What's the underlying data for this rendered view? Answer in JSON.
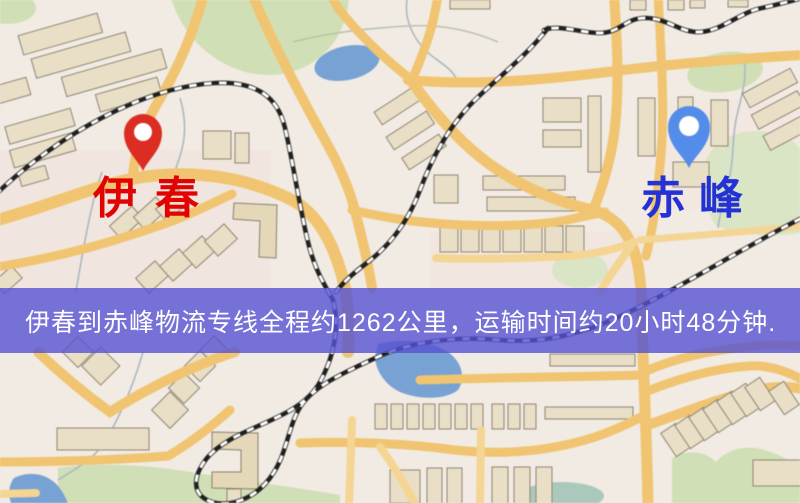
{
  "banner": {
    "text": "伊春到赤峰物流专线全程约1262公里，运输时间约20小时48分钟.",
    "background_color": "#5653d3",
    "text_color": "#ffffff",
    "origin": "伊春",
    "destination": "赤峰",
    "distance_km": "1262",
    "duration": "20小时48分钟"
  },
  "markers": {
    "origin": {
      "label": "伊春",
      "pin_color": "#e72a1d",
      "label_color": "#e20202"
    },
    "destination": {
      "label": "赤峰",
      "pin_color": "#4f8cf2",
      "label_color": "#2331d6"
    }
  },
  "map": {
    "palette": {
      "base": "#f2ebe2",
      "road": "#f3c468",
      "road_minor": "#f6d58d",
      "building": "#eadfc4",
      "green": "#cfe0b2",
      "water": "#74a2d8",
      "railway": "#1d1d1d"
    }
  }
}
